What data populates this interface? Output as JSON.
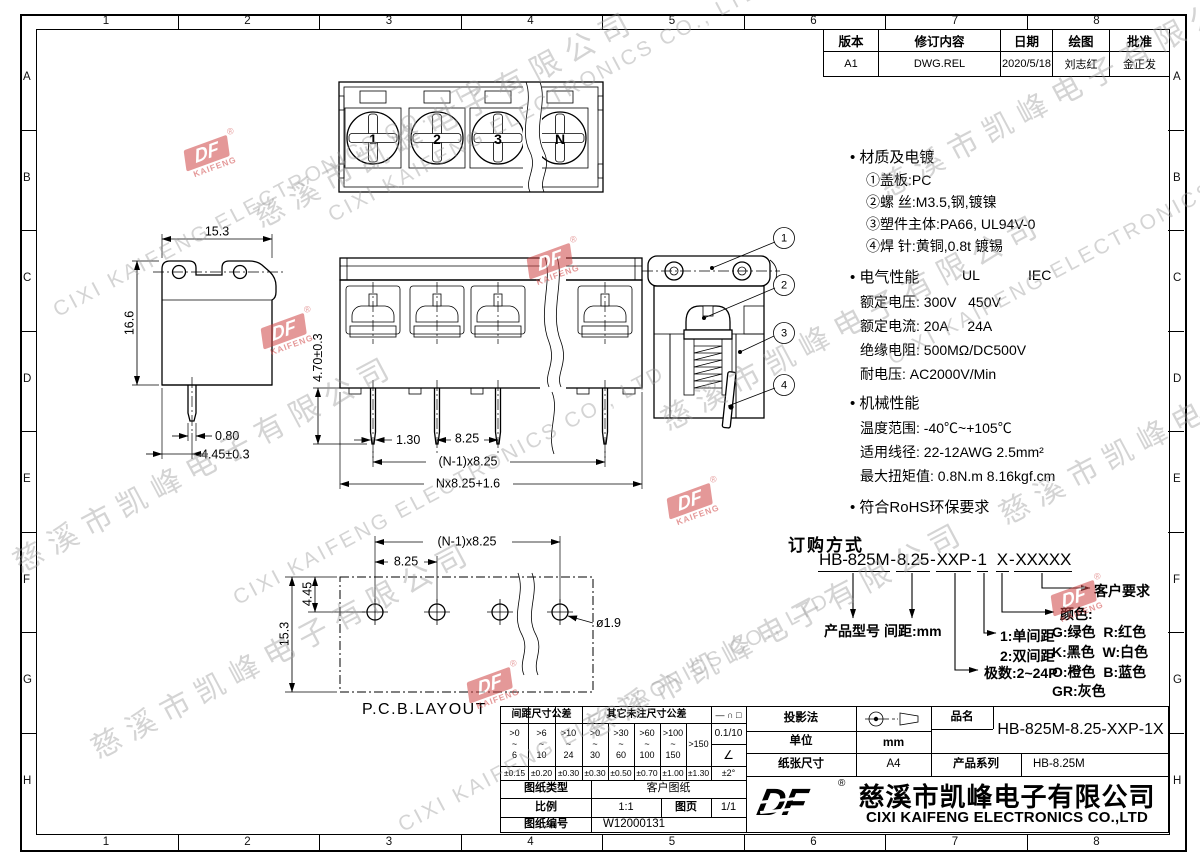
{
  "frame": {
    "cols": [
      "1",
      "2",
      "3",
      "4",
      "5",
      "6",
      "7",
      "8"
    ],
    "rows": [
      "A",
      "B",
      "C",
      "D",
      "E",
      "F",
      "G",
      "H"
    ]
  },
  "revision": {
    "headers": [
      "版本",
      "修订内容",
      "日期",
      "绘图",
      "批准"
    ],
    "row": {
      "version": "A1",
      "content": "DWG.REL",
      "date": "2020/5/18",
      "drawn": "刘志红",
      "approved": "金正发"
    }
  },
  "specs": {
    "material_title": "材质及电镀",
    "material_items": [
      "①盖板:PC",
      "②螺 丝:M3.5,钢,镀镍",
      "③塑件主体:PA66, UL94V-0",
      "④焊 针:黄铜,0.8t 镀锡"
    ],
    "elec_title": "电气性能",
    "elec_ul": "UL",
    "elec_iec": "IEC",
    "elec_items": [
      "额定电压: 300V   450V",
      "额定电流: 20A     24A",
      "绝缘电阻: 500MΩ/DC500V",
      "耐电压: AC2000V/Min"
    ],
    "mech_title": "机械性能",
    "mech_items": [
      "温度范围: -40℃~+105℃",
      "适用线径: 22-12AWG 2.5mm²",
      "最大扭矩值: 0.8N.m 8.16kgf.cm"
    ],
    "rohs": "符合RoHS环保要求"
  },
  "ordering": {
    "title": "订购方式",
    "parts": [
      "HB-825M",
      "-",
      "8.25",
      "-",
      "XXP",
      "-",
      "1",
      "X",
      "-",
      "XXXXX"
    ],
    "labels": {
      "model": "产品型号",
      "pitch": "间距:mm",
      "single": "1:单间距",
      "double": "2:双间距",
      "poles": "极数:2~24P",
      "colors_title": "颜色:",
      "colors": [
        "G:绿色  R:红色",
        "K:黑色  W:白色",
        "O:橙色  B:蓝色",
        "GR:灰色"
      ],
      "customer": "客户要求"
    }
  },
  "views": {
    "top_view": {
      "pole_numbers": [
        "1",
        "2",
        "3",
        "N"
      ]
    },
    "side_view": {
      "dim_width": "15.3",
      "dim_height": "16.6",
      "dim_pin_width": "0.80",
      "dim_pin_offset": "4.45±0.3"
    },
    "front_view": {
      "dim_pin_length": "4.70±0.3",
      "dim_pin_width": "1.30",
      "dim_pitch": "8.25",
      "dim_span": "(N-1)x8.25",
      "dim_total": "Nx8.25+1.6"
    },
    "section_view": {
      "balloons": [
        "1",
        "2",
        "3",
        "4"
      ]
    },
    "pcb_layout": {
      "dim_span": "(N-1)x8.25",
      "dim_pitch": "8.25",
      "dim_hole_offset": "4.45",
      "dim_depth": "15.3",
      "dim_hole": "ø1.9",
      "label": "P.C.B.LAYOUT"
    }
  },
  "title_block": {
    "tol": {
      "header_pitch": "间距尺寸公差",
      "header_other": "其它未注尺寸公差",
      "pitch_ranges": [
        ">0\n~\n6",
        ">6\n~\n10",
        ">10\n~\n24"
      ],
      "pitch_tols": [
        "±0.15",
        "±0.20",
        "±0.30"
      ],
      "other_ranges": [
        ">0\n~\n30",
        ">30\n~\n60",
        ">60\n~\n100",
        ">100\n~\n150"
      ],
      "over_range": ">150",
      "other_tols": [
        "±0.30",
        "±0.50",
        "±0.70",
        "±1.00"
      ],
      "over_tol": "±1.30",
      "symbols": "— ∩ □",
      "flatness": "0.1/10",
      "angle_sym": "∠",
      "angle_tol": "±2°"
    },
    "doc": {
      "type_label": "图纸类型",
      "type_value": "客户图纸",
      "scale_label": "比例",
      "scale_value": "1:1",
      "sheet_label": "图页",
      "sheet_value": "1/1",
      "no_label": "图纸编号",
      "no_value": "W12000131"
    },
    "proj": {
      "label": "投影法",
      "unit_label": "单位",
      "unit_value": "mm",
      "paper_label": "纸张尺寸",
      "paper_value": "A4"
    },
    "product": {
      "name_label": "品名",
      "name_value": "HB-825M-8.25-XXP-1X",
      "series_label": "产品系列",
      "series_value": "HB-8.25M"
    },
    "company": {
      "logo": "DF",
      "reg": "®",
      "cn": "慈溪市凯峰电子有限公司",
      "en": "CIXI KAIFENG ELECTRONICS CO.,LTD"
    }
  },
  "watermark": {
    "cn": "慈溪市凯峰电子有限公司",
    "en": "CIXI KAIFENG ELECTRONICS CO., LTD",
    "stamp_df": "DF",
    "stamp_sub": "KAIFENG",
    "reg": "®"
  }
}
